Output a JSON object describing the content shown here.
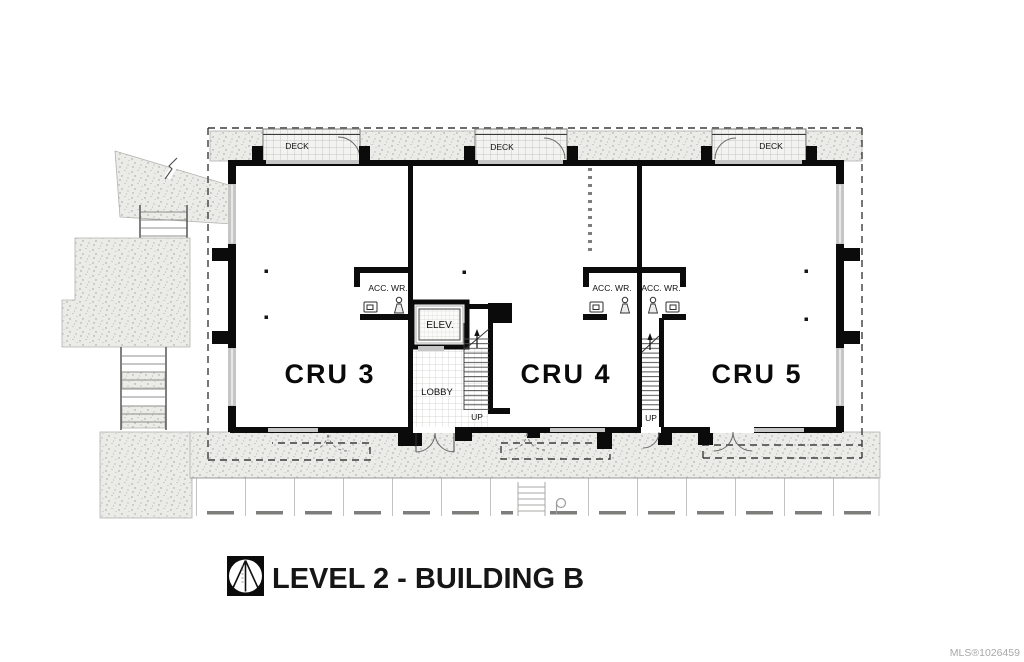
{
  "plan": {
    "decks": [
      "DECK",
      "DECK",
      "DECK"
    ],
    "units": [
      {
        "label": "CRU 3"
      },
      {
        "label": "CRU 4"
      },
      {
        "label": "CRU 5"
      }
    ],
    "rooms": {
      "elevator": "ELEV.",
      "lobby": "LOBBY",
      "wr_labels": [
        "ACC. WR.",
        "ACC. WR.",
        "ACC. WR."
      ],
      "up_labels": [
        "UP",
        "UP"
      ]
    }
  },
  "title_block": {
    "title": "LEVEL 2 - BUILDING B"
  },
  "watermark": {
    "text": "MLS®1026459"
  },
  "colors": {
    "wall": "#0b0b0b",
    "glass": "#c6c6c6",
    "boundary_dash": "#3c3c3c",
    "stipple_bg": "#ebebe8",
    "watermark": "#a8a8a8"
  }
}
